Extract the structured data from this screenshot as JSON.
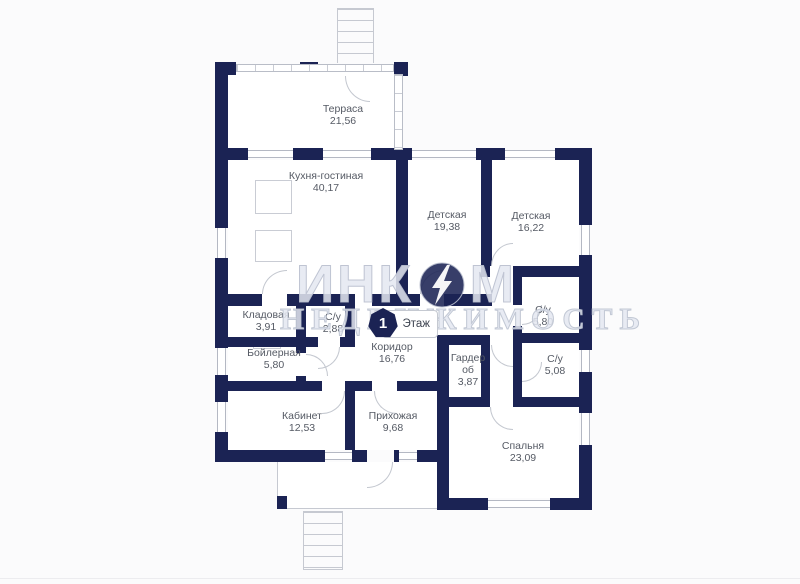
{
  "plan": {
    "floor_badge": {
      "number": "1",
      "label": "Этаж"
    },
    "watermark": {
      "brand_prefix": "ИНК",
      "brand_suffix": "М",
      "subtitle": "НЕДВИЖИМОСТЬ"
    },
    "rooms": [
      {
        "id": "terrace",
        "name": "Терраса",
        "area": "21,56"
      },
      {
        "id": "kitchen-living",
        "name": "Кухня-гостиная",
        "area": "40,17"
      },
      {
        "id": "nursery-1",
        "name": "Детская",
        "area": "19,38"
      },
      {
        "id": "nursery-2",
        "name": "Детская",
        "area": "16,22"
      },
      {
        "id": "pantry",
        "name": "Кладовая",
        "area": "3,91"
      },
      {
        "id": "wc-288",
        "name": "С/у",
        "area": "2,88"
      },
      {
        "id": "wc-580",
        "name": "С/у",
        "area": "5,80"
      },
      {
        "id": "boiler-room",
        "name": "Бойлерная",
        "area": "5,80"
      },
      {
        "id": "corridor",
        "name": "Коридор",
        "area": "16,76"
      },
      {
        "id": "wardrobe",
        "name": "Гардероб",
        "area": "3,87"
      },
      {
        "id": "wc-508",
        "name": "С/у",
        "area": "5,08"
      },
      {
        "id": "study",
        "name": "Кабинет",
        "area": "12,53"
      },
      {
        "id": "hallway",
        "name": "Прихожая",
        "area": "9,68"
      },
      {
        "id": "bedroom",
        "name": "Спальня",
        "area": "23,09"
      }
    ]
  },
  "colors": {
    "wall": "#1b2354",
    "line": "#c3c7cf",
    "label_text": "#555a64",
    "watermark": "#dfe3ec",
    "background": "#fbfbfc"
  }
}
